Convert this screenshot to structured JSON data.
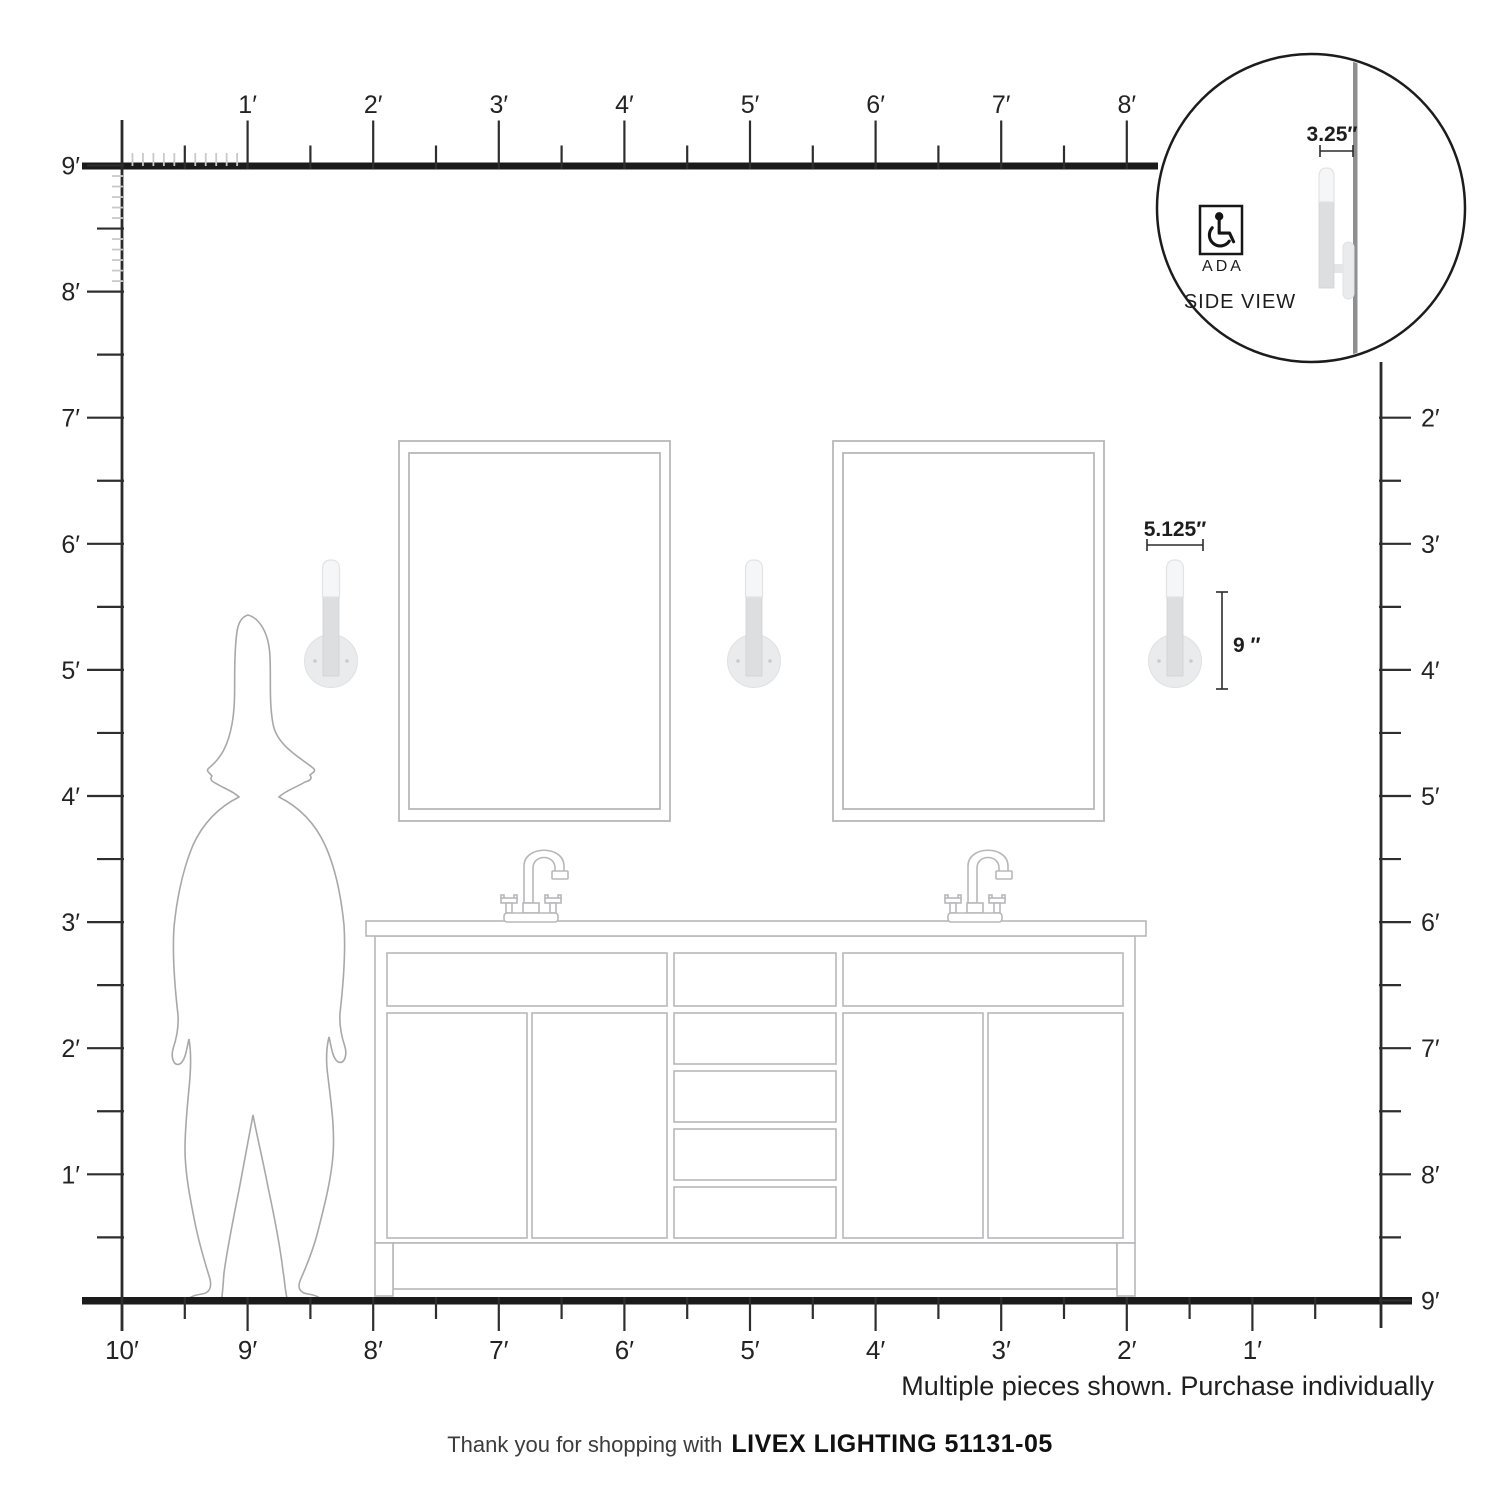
{
  "title": "Livex Lighting 51131-05 dimension diagram",
  "inset": {
    "offset_dimension": "3.25″",
    "ada_label": "ADA",
    "view_label": "SIDE VIEW"
  },
  "fixture": {
    "width_dimension": "5.125″",
    "height_dimension": "9 ″"
  },
  "rulers": {
    "top_feet": [
      "1′",
      "2′",
      "3′",
      "4′",
      "5′",
      "6′",
      "7′",
      "8′"
    ],
    "left_feet": [
      "9′",
      "8′",
      "7′",
      "6′",
      "5′",
      "4′",
      "3′",
      "2′",
      "1′"
    ],
    "right_feet": [
      "2′",
      "3′",
      "4′",
      "5′",
      "6′",
      "7′",
      "8′",
      "9′"
    ],
    "bottom_feet": [
      "10′",
      "9′",
      "8′",
      "7′",
      "6′",
      "5′",
      "4′",
      "3′",
      "2′",
      "1′"
    ]
  },
  "footer": {
    "disclaimer": "Multiple pieces shown. Purchase individually",
    "thanks_prefix": "Thank you for shopping with",
    "brand_model": "LIVEX LIGHTING 51131-05"
  },
  "colors": {
    "ruler_line": "#1a1a1a",
    "tick": "#2e2e2e",
    "inch_tick": "#c9c9c9",
    "furniture_outline": "#b7b8ba",
    "sconce_plate": "#eaebec",
    "sconce_stem": "#dcdee0",
    "sconce_glass": "#f5f6f7",
    "side_wall": "#8e8f90",
    "text": "#232323"
  }
}
